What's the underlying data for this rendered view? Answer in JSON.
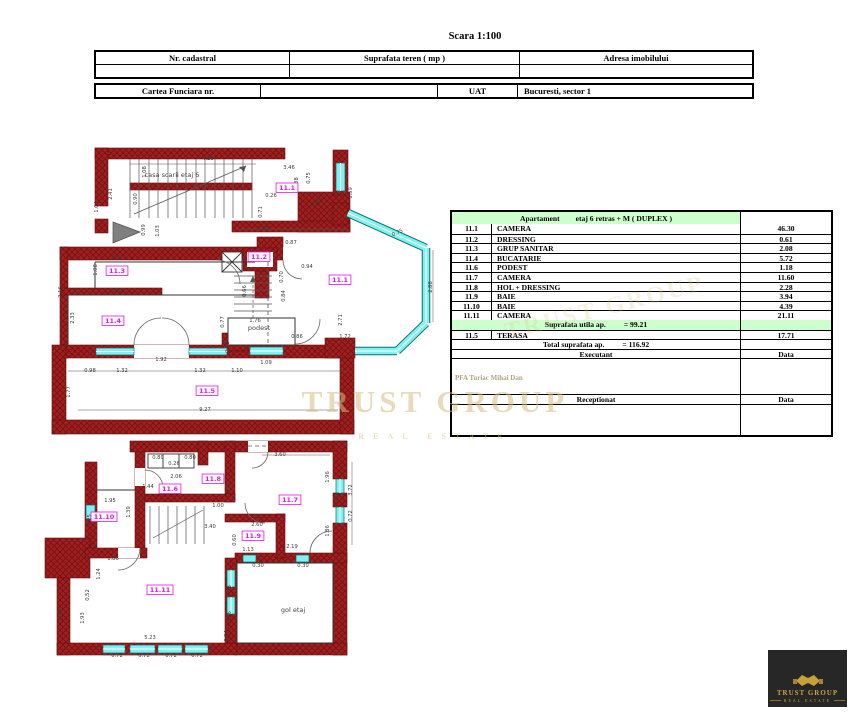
{
  "title": "Scara 1:100",
  "cadastral_table": {
    "col1": "Nr. cadastral",
    "col2": "Suprafata teren ( mp )",
    "col3": "Adresa imobilului"
  },
  "funciara_table": {
    "col1": "Cartea Funciara nr.",
    "uat_label": "UAT",
    "uat_value": "Bucuresti, sector 1"
  },
  "apartment_table": {
    "header_left": "Apartament",
    "header_right": "etaj 6 retras + M ( DUPLEX )",
    "rows": [
      {
        "no": "11.1",
        "name": "CAMERA",
        "area": "46.30"
      },
      {
        "no": "11.2",
        "name": "DRESSING",
        "area": "0.61"
      },
      {
        "no": "11.3",
        "name": "GRUP SANITAR",
        "area": "2.08"
      },
      {
        "no": "11.4",
        "name": "BUCATARIE",
        "area": "5.72"
      },
      {
        "no": "11.6",
        "name": "PODEST",
        "area": "1.18"
      },
      {
        "no": "11.7",
        "name": "CAMERA",
        "area": "11.60"
      },
      {
        "no": "11.8",
        "name": "HOL + DRESSING",
        "area": "2.28"
      },
      {
        "no": "11.9",
        "name": "BAIE",
        "area": "3.94"
      },
      {
        "no": "11.10",
        "name": "BAIE",
        "area": "4.39"
      },
      {
        "no": "11.11",
        "name": "CAMERA",
        "area": "21.11"
      }
    ],
    "utila_label": "Suprafata utila ap.",
    "utila_value": "= 99.21",
    "terasa_row": {
      "no": "11.5",
      "name": "TERASA",
      "area": "17.71"
    },
    "total_label": "Total suprafata ap.",
    "total_value": "= 116.92",
    "executant_label": "Executant",
    "executant_name": "PFA Turiac Mihai Dan",
    "receptionat_label": "Receptionat",
    "data_label": "Data"
  },
  "watermark": {
    "line1": "TRUST GROUP",
    "line2": "REAL ESTATE"
  },
  "logo": {
    "line1": "TRUST GROUP",
    "line2": "REAL ESTATE"
  },
  "colors": {
    "wall_red": "#a02020",
    "window_cyan": "#7ef2f2",
    "room_label_magenta": "#e714e7",
    "table_green": "#ccffcc",
    "gold": "#c9a13b"
  },
  "plans": {
    "upper": {
      "texts": [
        {
          "x": 172,
          "y": 177,
          "t": "casa scarii etaj 6"
        },
        {
          "x": 259,
          "y": 330,
          "t": "podest"
        }
      ],
      "rooms": [
        {
          "x": 287,
          "y": 190,
          "t": "11.1"
        },
        {
          "x": 340,
          "y": 282,
          "t": "11.1"
        },
        {
          "x": 259,
          "y": 259,
          "t": "11.2"
        },
        {
          "x": 117,
          "y": 273,
          "t": "11.3"
        },
        {
          "x": 113,
          "y": 323,
          "t": "11.4"
        },
        {
          "x": 207,
          "y": 393,
          "t": "11.5"
        }
      ],
      "dims": [
        {
          "x": 208,
          "y": 160,
          "t": "4.29"
        },
        {
          "x": 146,
          "y": 172,
          "t": "1.08",
          "r": -90
        },
        {
          "x": 112,
          "y": 194,
          "t": "2.41",
          "r": -90
        },
        {
          "x": 98,
          "y": 207,
          "t": "1.04",
          "r": -90
        },
        {
          "x": 137,
          "y": 199,
          "t": "0.90",
          "r": -90
        },
        {
          "x": 263,
          "y": 230,
          "t": "3.08"
        },
        {
          "x": 352,
          "y": 193,
          "t": "1.59",
          "r": -90
        },
        {
          "x": 318,
          "y": 203,
          "t": "3.84",
          "r": -42
        },
        {
          "x": 145,
          "y": 230,
          "t": "0.99",
          "r": -90
        },
        {
          "x": 159,
          "y": 231,
          "t": "1.03",
          "r": -90
        },
        {
          "x": 289,
          "y": 169,
          "t": "3.46"
        },
        {
          "x": 298,
          "y": 183,
          "t": "1.38",
          "r": -90
        },
        {
          "x": 310,
          "y": 178,
          "t": "0.75",
          "r": -90
        },
        {
          "x": 271,
          "y": 197,
          "t": "0.26"
        },
        {
          "x": 262,
          "y": 212,
          "t": "0.71",
          "r": -90
        },
        {
          "x": 291,
          "y": 244,
          "t": "0.87"
        },
        {
          "x": 307,
          "y": 268,
          "t": "0.94"
        },
        {
          "x": 283,
          "y": 277,
          "t": "0.70",
          "r": -90
        },
        {
          "x": 117,
          "y": 259,
          "t": "2.02"
        },
        {
          "x": 97,
          "y": 270,
          "t": "1.08",
          "r": -90
        },
        {
          "x": 116,
          "y": 292,
          "t": "2.39"
        },
        {
          "x": 62,
          "y": 292,
          "t": "2.16",
          "r": -90
        },
        {
          "x": 74,
          "y": 318,
          "t": "2.33",
          "r": -90
        },
        {
          "x": 246,
          "y": 291,
          "t": "0.66",
          "r": -90
        },
        {
          "x": 285,
          "y": 296,
          "t": "0.84",
          "r": -90
        },
        {
          "x": 255,
          "y": 322,
          "t": "1.76"
        },
        {
          "x": 224,
          "y": 322,
          "t": "0.77",
          "r": -90
        },
        {
          "x": 229,
          "y": 347,
          "t": "0.73",
          "r": -90
        },
        {
          "x": 297,
          "y": 338,
          "t": "0.86"
        },
        {
          "x": 345,
          "y": 338,
          "t": "1.72"
        },
        {
          "x": 398,
          "y": 234,
          "t": "0.75",
          "r": -25
        },
        {
          "x": 432,
          "y": 287,
          "t": "2.88",
          "r": -90
        },
        {
          "x": 342,
          "y": 320,
          "t": "2.71",
          "r": -90
        },
        {
          "x": 161,
          "y": 361,
          "t": "1.92"
        },
        {
          "x": 90,
          "y": 372,
          "t": "0.98"
        },
        {
          "x": 122,
          "y": 372,
          "t": "1.32"
        },
        {
          "x": 200,
          "y": 372,
          "t": "1.32"
        },
        {
          "x": 237,
          "y": 372,
          "t": "1.10"
        },
        {
          "x": 266,
          "y": 364,
          "t": "1.09"
        },
        {
          "x": 70,
          "y": 392,
          "t": "1.77",
          "r": -90
        },
        {
          "x": 205,
          "y": 411,
          "t": "9.27"
        }
      ]
    },
    "lower": {
      "texts": [
        {
          "x": 293,
          "y": 612,
          "t": "gol etaj"
        }
      ],
      "rooms": [
        {
          "x": 170,
          "y": 491,
          "t": "11.6"
        },
        {
          "x": 213,
          "y": 481,
          "t": "11.8"
        },
        {
          "x": 290,
          "y": 502,
          "t": "11.7"
        },
        {
          "x": 104,
          "y": 519,
          "t": "11.10"
        },
        {
          "x": 253,
          "y": 538,
          "t": "11.9"
        },
        {
          "x": 160,
          "y": 592,
          "t": "11.11"
        }
      ],
      "dims": [
        {
          "x": 158,
          "y": 459,
          "t": "0.80"
        },
        {
          "x": 174,
          "y": 465,
          "t": "0.26"
        },
        {
          "x": 190,
          "y": 459,
          "t": "0.80"
        },
        {
          "x": 280,
          "y": 456,
          "t": "3.60"
        },
        {
          "x": 110,
          "y": 502,
          "t": "1.95"
        },
        {
          "x": 130,
          "y": 512,
          "t": "1.39",
          "r": -90
        },
        {
          "x": 91,
          "y": 520,
          "t": "2.25",
          "r": -90
        },
        {
          "x": 148,
          "y": 488,
          "t": "1.44"
        },
        {
          "x": 142,
          "y": 501,
          "t": "1.13",
          "r": -90
        },
        {
          "x": 176,
          "y": 478,
          "t": "2.06"
        },
        {
          "x": 230,
          "y": 487,
          "t": "2.51",
          "r": -90
        },
        {
          "x": 218,
          "y": 507,
          "t": "1.00"
        },
        {
          "x": 210,
          "y": 528,
          "t": "3.40"
        },
        {
          "x": 329,
          "y": 477,
          "t": "1.96",
          "r": -90
        },
        {
          "x": 352,
          "y": 490,
          "t": "3.72",
          "r": -90
        },
        {
          "x": 339,
          "y": 498,
          "t": "0.28",
          "r": -90
        },
        {
          "x": 352,
          "y": 516,
          "t": "0.72",
          "r": -90
        },
        {
          "x": 329,
          "y": 531,
          "t": "1.86",
          "r": -90
        },
        {
          "x": 257,
          "y": 518,
          "t": "1.21"
        },
        {
          "x": 257,
          "y": 526,
          "t": "2.60"
        },
        {
          "x": 248,
          "y": 551,
          "t": "1.13"
        },
        {
          "x": 292,
          "y": 548,
          "t": "2.19"
        },
        {
          "x": 236,
          "y": 540,
          "t": "0.60",
          "r": -90
        },
        {
          "x": 113,
          "y": 560,
          "t": "1.86"
        },
        {
          "x": 100,
          "y": 574,
          "t": "1.24",
          "r": -90
        },
        {
          "x": 89,
          "y": 595,
          "t": "0.52",
          "r": -90
        },
        {
          "x": 84,
          "y": 618,
          "t": "1.93",
          "r": -90
        },
        {
          "x": 63,
          "y": 615,
          "t": "1.74",
          "r": -90
        },
        {
          "x": 231,
          "y": 591,
          "t": "4.28",
          "r": -90
        },
        {
          "x": 231,
          "y": 617,
          "t": "0.96",
          "r": -90
        },
        {
          "x": 150,
          "y": 639,
          "t": "5.23"
        },
        {
          "x": 117,
          "y": 657,
          "t": "0.72"
        },
        {
          "x": 144,
          "y": 657,
          "t": "0.72"
        },
        {
          "x": 171,
          "y": 657,
          "t": "0.72"
        },
        {
          "x": 197,
          "y": 657,
          "t": "0.72"
        },
        {
          "x": 228,
          "y": 636,
          "t": "0.24",
          "r": -90
        },
        {
          "x": 258,
          "y": 567,
          "t": "0.30"
        },
        {
          "x": 303,
          "y": 567,
          "t": "0.30"
        }
      ]
    }
  }
}
